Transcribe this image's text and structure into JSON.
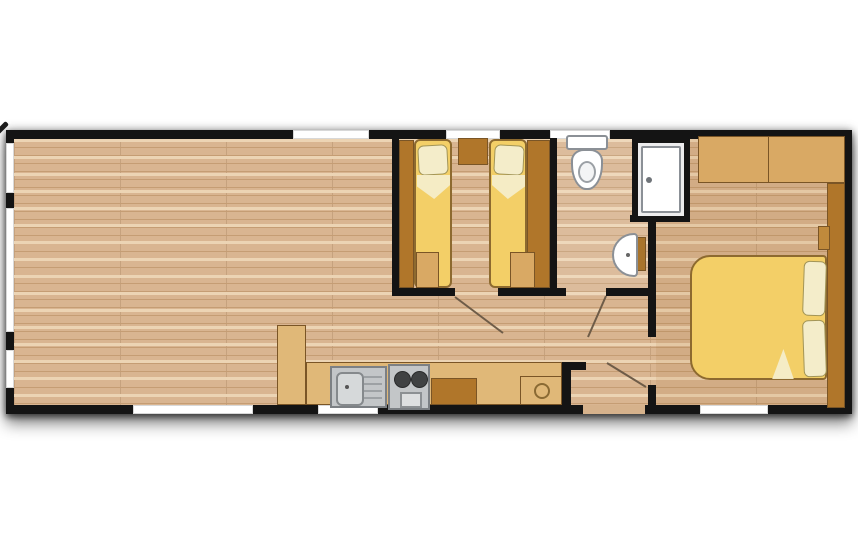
{
  "diagram": {
    "type": "floor-plan",
    "rooms": [
      {
        "name": "living-area"
      },
      {
        "name": "kitchen"
      },
      {
        "name": "twin-bedroom"
      },
      {
        "name": "bathroom"
      },
      {
        "name": "master-bedroom"
      },
      {
        "name": "hallway"
      }
    ],
    "fixtures": [
      {
        "name": "kitchen-sink"
      },
      {
        "name": "cooker"
      },
      {
        "name": "tall-cabinet"
      },
      {
        "name": "base-cabinet"
      },
      {
        "name": "water-heater-cabinet"
      },
      {
        "name": "single-bed",
        "count": 2
      },
      {
        "name": "nightstand"
      },
      {
        "name": "foot-cabinet",
        "count": 2
      },
      {
        "name": "toilet"
      },
      {
        "name": "shower-cubicle"
      },
      {
        "name": "wash-basin"
      },
      {
        "name": "wardrobe"
      },
      {
        "name": "double-bed"
      },
      {
        "name": "pillow",
        "count": 4
      }
    ],
    "window_count": 9,
    "door_opening_count": 4
  },
  "colors": {
    "wall": "#141414",
    "floor_base": "#d9b591",
    "floor_light": "#ecd4b4",
    "floor_line": "#c59d74",
    "column_line": "rgba(110,75,40,0.18)",
    "bed": "#f3cf67",
    "bed_outline": "#8d6a2f",
    "pillow": "#f4edca",
    "pillow_outline": "#a29557",
    "wood_dark": "#b0762a",
    "wood_mid": "#d9a964",
    "wood_light": "#e0b878",
    "wood_outline": "#7a5526",
    "appliance": "#c3c6c8",
    "appliance_outline": "#7c8084",
    "burner": "#404243",
    "oven": "#dddfe0",
    "fixture_white": "#ffffff",
    "fixture_outline": "#8b9096",
    "window": "#ffffff",
    "swing_line": "#6e5c48",
    "vanity": "#a8742c"
  }
}
